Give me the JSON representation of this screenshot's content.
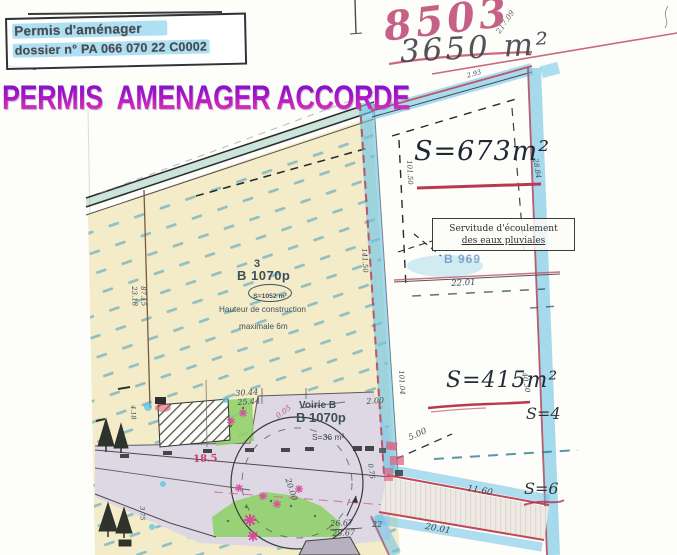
{
  "header": {
    "stamp": {
      "line1": "Permis d'aménager",
      "line2": "dossier n° PA 066 070 22 C0002"
    },
    "approval": {
      "word1": "PERMIS",
      "word2": "AMENAGER ACCORDE"
    },
    "handwriting": {
      "plan_number": "8503",
      "total_area": "3650 m²"
    }
  },
  "plan": {
    "lot3": {
      "number": "3",
      "code": "B 1070p",
      "area": "S=1052 m²",
      "height_note_line1": "Hauteur de construction",
      "height_note_line2": "maximale 6m"
    },
    "lot_673": {
      "area": "S=673m²"
    },
    "lot_415": {
      "area": "S=415m²"
    },
    "lot_east_upper": {
      "area": "S=4"
    },
    "lot_east_lower": {
      "area": "S=6"
    },
    "voirie": {
      "label": "Voirie B",
      "code": "B 1070p",
      "area": "S=36 m²"
    },
    "drain_ref": "B 969",
    "servitude": {
      "line1": "Servitude d'écoulement",
      "line2": "des eaux pluviales"
    }
  },
  "measurements": {
    "d3044": "30.44",
    "d2544": "25.44",
    "d200": "2.00",
    "d185": "18.5",
    "d2667": "26.67",
    "d2867": "28.67",
    "d2201": "22.01",
    "d500": "5.00",
    "d1160": "11.60",
    "d2001": "20.01",
    "d10150": "101.50",
    "d14150": "141.50",
    "d2318": "23.18",
    "d8715": "87.15",
    "d293": "2.93",
    "d10104": "101.04",
    "d4030": "40.30",
    "d2884": "28.84",
    "d2000": "20.00",
    "d21709": "217.09",
    "d005": "0.05",
    "d075": "0.75",
    "d418": "4.18",
    "d375": "3.75",
    "d22": "22"
  },
  "colors": {
    "highlight_blue": "#6cc4e6",
    "boundary_red": "#c0485a",
    "parcel_cream": "#f4ecc9",
    "road_lavender": "#ded8e4",
    "green_space": "#90d06a",
    "title_magenta": "#a714c4",
    "ink_red": "#c24f68",
    "hatch_dark": "#41413d"
  }
}
